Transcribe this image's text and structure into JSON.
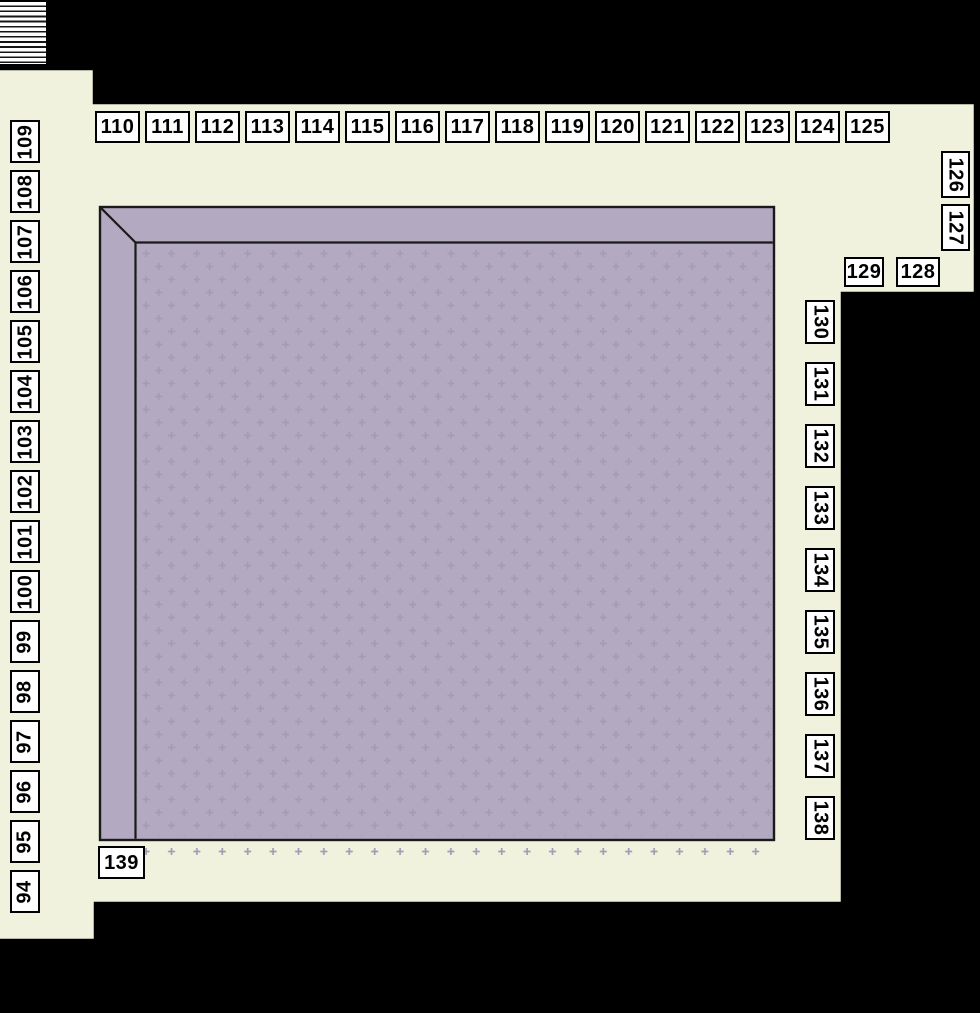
{
  "diagram": {
    "type": "exhibit-floor-plan",
    "booths": {
      "left_column_labels": [
        "109",
        "108",
        "107",
        "106",
        "105",
        "104",
        "103",
        "102",
        "101",
        "100",
        "99",
        "98",
        "97",
        "96",
        "95",
        "94"
      ],
      "top_row_labels": [
        "110",
        "111",
        "112",
        "113",
        "114",
        "115",
        "116",
        "117",
        "118",
        "119",
        "120",
        "121",
        "122",
        "123",
        "124",
        "125"
      ],
      "right_column_labels": [
        "130",
        "131",
        "132",
        "133",
        "134",
        "135",
        "136",
        "137",
        "138"
      ],
      "upper_right_vertical_labels": [
        "126",
        "127"
      ],
      "upper_right_horizontal_labels": [
        "129",
        "128"
      ],
      "bottom_left_label": "139"
    },
    "icons": {
      "top_left_block": "hatched-ramp"
    },
    "colors": {
      "background": "#000000",
      "floor": "#f0f2de",
      "outline": "#000000",
      "hall_fill": "#b3a9c0",
      "hall_pattern": "#a49cb3",
      "hall_stroke": "#1a1a1a",
      "label_background": "#ffffff",
      "label_border": "#000000",
      "label_text": "#000000"
    }
  }
}
